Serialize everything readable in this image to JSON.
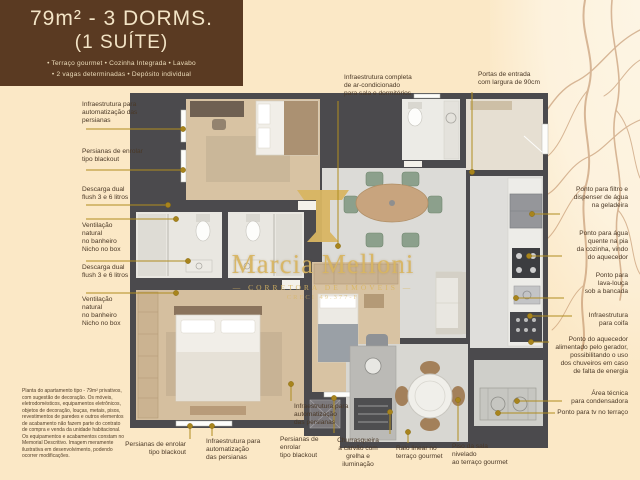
{
  "header": {
    "title_line1": "79m² - 3 DORMS.",
    "title_line2": "(1 SUÍTE)",
    "features_line1": "• Terraço gourmet • Cozinha Integrada • Lavabo",
    "features_line2": "• 2 vagas determinadas • Depósito individual"
  },
  "watermark": {
    "name": "Marcia Melloni",
    "subtitle": "— CORRETORA DE IMÓVEIS —",
    "creci": "CRECI 49.377-F"
  },
  "annotations": {
    "left": [
      "Infraestrutura para\nautomatização das\npersianas",
      "Persianas de enrolar\ntipo blackout",
      "Descarga dual\nflush 3 e 6 litros",
      "Ventilação\nnatural\nno banheiro\nNicho no box",
      "Descarga dual\nflush 3 e 6 litros",
      "Ventilação\nnatural\nno banheiro\nNicho no box"
    ],
    "top": [
      "Infraestrutura completa\nde ar-condicionado\npara sala e dormitórios",
      "Portas de entrada\ncom largura de 90cm"
    ],
    "right": [
      "Ponto para filtro e\ndispenser de água\nna geladeira",
      "Ponto para água\nquente na pia\nda cozinha, vindo\ndo aquecedor",
      "Ponto para\nlava-louça\nsob a bancada",
      "Infraestrutura\npara coifa",
      "Ponto do aquecedor\nalimentado pelo gerador,\npossibilitando o uso\ndos chuveiros em caso\nde falta de energia",
      "Área técnica\npara condensadora",
      "Ponto para tv no terraço"
    ],
    "bottom": [
      "Persianas de enrolar\ntipo blackout",
      "Infraestrutura para\nautomatização\ndas persianas",
      "Infraestrutura para\nautomatização\ndas persianas",
      "Persianas de enrolar\ntipo blackout",
      "Churrasqueira\na carvão com\ngrelha e iluminação",
      "Ralo linear no\nterraço gourmet",
      "Piso da sala\nnivelado\nao terraço gourmet"
    ]
  },
  "disclaimer": {
    "text": "Planta do apartamento tipo - 79m² privativos, com sugestão de decoração. Os móveis, eletrodomésticos, equipamentos eletrônicos, objetos de decoração, louças, metais, pisos, revestimentos de paredes e outros elementos de acabamento não fazem parte do contrato de compra e venda da unidade habitacional. Os equipamentos e acabamentos constam no Memorial Descritivo. Imagem meramente ilustrativa em desenvolvimento, podendo ocorrer modificações."
  },
  "colors": {
    "brand_brown": "#5a3a22",
    "background_cream": "#fbe8c6",
    "leader_gold": "#b08d1f",
    "watermark_gold": "#d8b562",
    "wall_gray": "#4b4a4d"
  }
}
